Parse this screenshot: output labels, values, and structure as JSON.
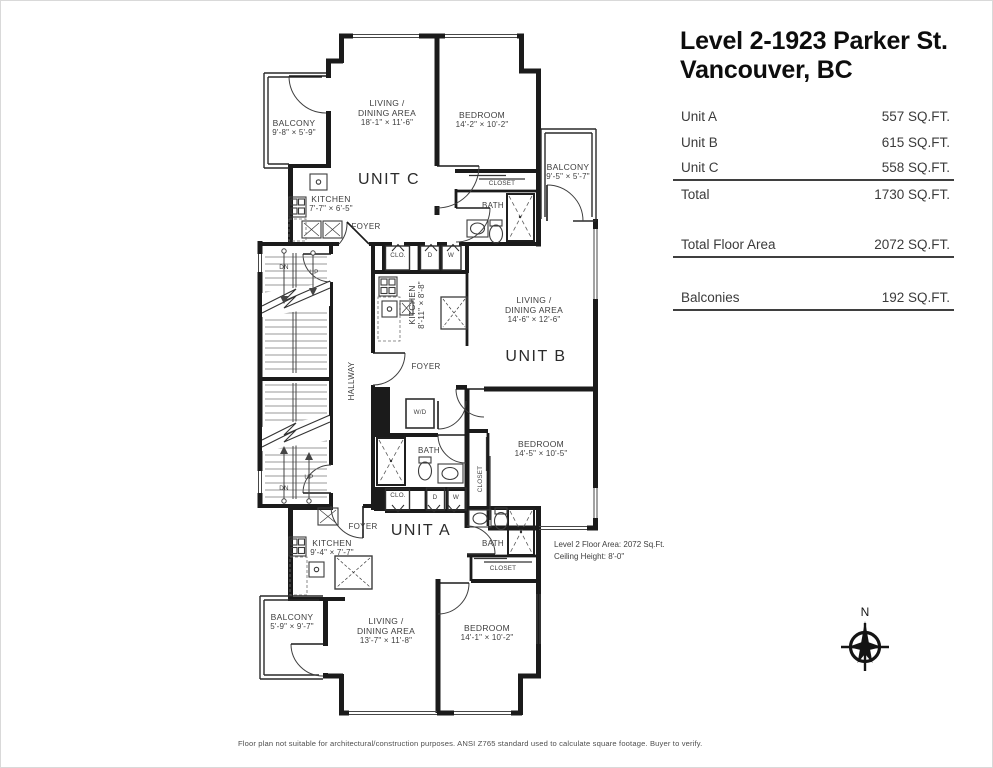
{
  "header": {
    "title_line1": "Level 2-1923 Parker St.",
    "title_line2": "Vancouver, BC"
  },
  "area_table": {
    "rows": [
      {
        "label": "Unit A",
        "value": "557 SQ.FT."
      },
      {
        "label": "Unit B",
        "value": "615 SQ.FT."
      },
      {
        "label": "Unit C",
        "value": "558 SQ.FT."
      },
      {
        "label": "Total",
        "value": "1730 SQ.FT."
      },
      {
        "label": "Total Floor Area",
        "value": "2072 SQ.FT."
      },
      {
        "label": "Balconies",
        "value": "192 SQ.FT."
      }
    ]
  },
  "plan": {
    "units": {
      "a": {
        "label": "UNIT A"
      },
      "b": {
        "label": "UNIT B"
      },
      "c": {
        "label": "UNIT C"
      }
    },
    "rooms": {
      "living_c": {
        "line1": "LIVING /",
        "line2": "DINING AREA",
        "dims": "18'-1\" × 11'-6\""
      },
      "bedroom_c": {
        "line1": "BEDROOM",
        "dims": "14'-2\" × 10'-2\""
      },
      "balcony_c": {
        "line1": "BALCONY",
        "dims": "9'-8\" × 5'-9\""
      },
      "kitchen_c": {
        "line1": "KITCHEN",
        "dims": "7'-7\" × 6'-5\""
      },
      "balcony_b": {
        "line1": "BALCONY",
        "dims": "9'-5\" × 5'-7\""
      },
      "kitchen_b": {
        "line1": "KITCHEN",
        "dims": "8'-11\" × 8'-8\""
      },
      "living_b": {
        "line1": "LIVING /",
        "line2": "DINING AREA",
        "dims": "14'-6\" × 12'-6\""
      },
      "bedroom_b": {
        "line1": "BEDROOM",
        "dims": "14'-5\" × 10'-5\""
      },
      "kitchen_a": {
        "line1": "KITCHEN",
        "dims": "9'-4\" × 7'-7\""
      },
      "living_a": {
        "line1": "LIVING /",
        "line2": "DINING AREA",
        "dims": "13'-7\" × 11'-8\""
      },
      "bedroom_a": {
        "line1": "BEDROOM",
        "dims": "14'-1\" × 10'-2\""
      },
      "balcony_a": {
        "line1": "BALCONY",
        "dims": "5'-9\" × 9'-7\""
      }
    },
    "labels": {
      "foyer": "FOYER",
      "bath": "BATH",
      "closet": "CLOSET",
      "clo": "CLO.",
      "d": "D",
      "w": "W",
      "wd": "W/D",
      "hallway": "HALLWAY",
      "dn": "DN",
      "up": "UP"
    },
    "note": {
      "line1": "Level 2 Floor Area: 2072 Sq.Ft.",
      "line2": "Ceiling Height: 8'-0\""
    },
    "compass": {
      "label": "N"
    }
  },
  "footer": {
    "disclaimer": "Floor plan not suitable for architectural/construction purposes. ANSI Z765 standard used to calculate square footage. Buyer to verify."
  }
}
